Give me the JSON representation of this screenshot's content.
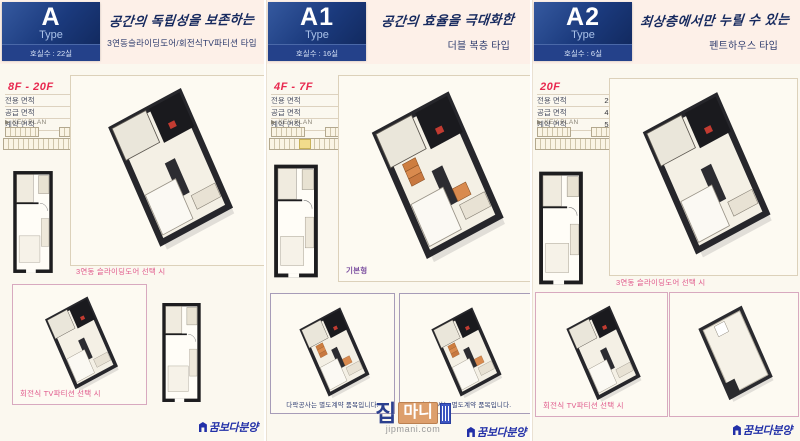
{
  "colors": {
    "background": "#fbf8ef",
    "headline_band": "#fdf0e8",
    "badge_navy": "#1b3a7d",
    "floor_red": "#e8284f",
    "caption_pink": "#e05a8c",
    "caption_purple": "#7c4fa0",
    "caption_navy": "#2e3d72",
    "brand_blue": "#2230a8",
    "stair_orange": "#cd7d3f",
    "watermark_orange": "#dd9f6c"
  },
  "sections": [
    {
      "type_label": "A",
      "type_word": "Type",
      "unit_count": "호실수 : 22실",
      "headline": "공간의 독립성을 보존하는",
      "subheadline": "3연동슬라이딩도어/회전식TV파티션 타입",
      "floor_range": "8F - 20F",
      "areas": [
        {
          "label": "전용 면적",
          "value": "29.0424㎡"
        },
        {
          "label": "공급 면적",
          "value": "41.3548㎡"
        },
        {
          "label": "계약 면적",
          "value": "53.9490㎡"
        }
      ],
      "keyplan_label": "▶ KEY PLAN",
      "main_caption": "3연동 슬라이딩도어 선택 시",
      "option_caption": "회전식 TV파티션 선택 시",
      "logo": "꿈보다분양"
    },
    {
      "type_label": "A1",
      "type_word": "Type",
      "unit_count": "호실수 : 16실",
      "headline": "공간의 효율을 극대화한",
      "subheadline": "더블 복층 타입",
      "floor_range": "4F - 7F",
      "areas": [
        {
          "label": "전용 면적",
          "value": "29.0424㎡"
        },
        {
          "label": "공급 면적",
          "value": "41.0440㎡"
        },
        {
          "label": "계약 면적",
          "value": "53.0400㎡"
        }
      ],
      "keyplan_label": "▶ KEY PLAN",
      "main_caption": "기본형",
      "box_caption_left": "다락공사는 별도계약 품목입니다.",
      "box_caption_right": "다락공사는 별도계약 품목입니다.",
      "logo": "꿈보다분양"
    },
    {
      "type_label": "A2",
      "type_word": "Type",
      "unit_count": "호실수 : 6실",
      "headline": "최상층에서만 누릴 수 있는",
      "subheadline": "펜트하우스 타입",
      "floor_range": "20F",
      "areas": [
        {
          "label": "전용 면적",
          "value": "29.0424㎡"
        },
        {
          "label": "공급 면적",
          "value": "41.3548㎡"
        },
        {
          "label": "계약 면적",
          "value": "53.9490㎡"
        }
      ],
      "keyplan_label": "▶ KEY PLAN",
      "main_caption": "3연동 슬라이딩도어 선택 시",
      "option_caption": "회전식 TV파티션 선택 시",
      "logo": "꿈보다분양"
    }
  ],
  "watermark": {
    "word1": "집",
    "word2": "마니",
    "domain": "jipmani.com"
  }
}
